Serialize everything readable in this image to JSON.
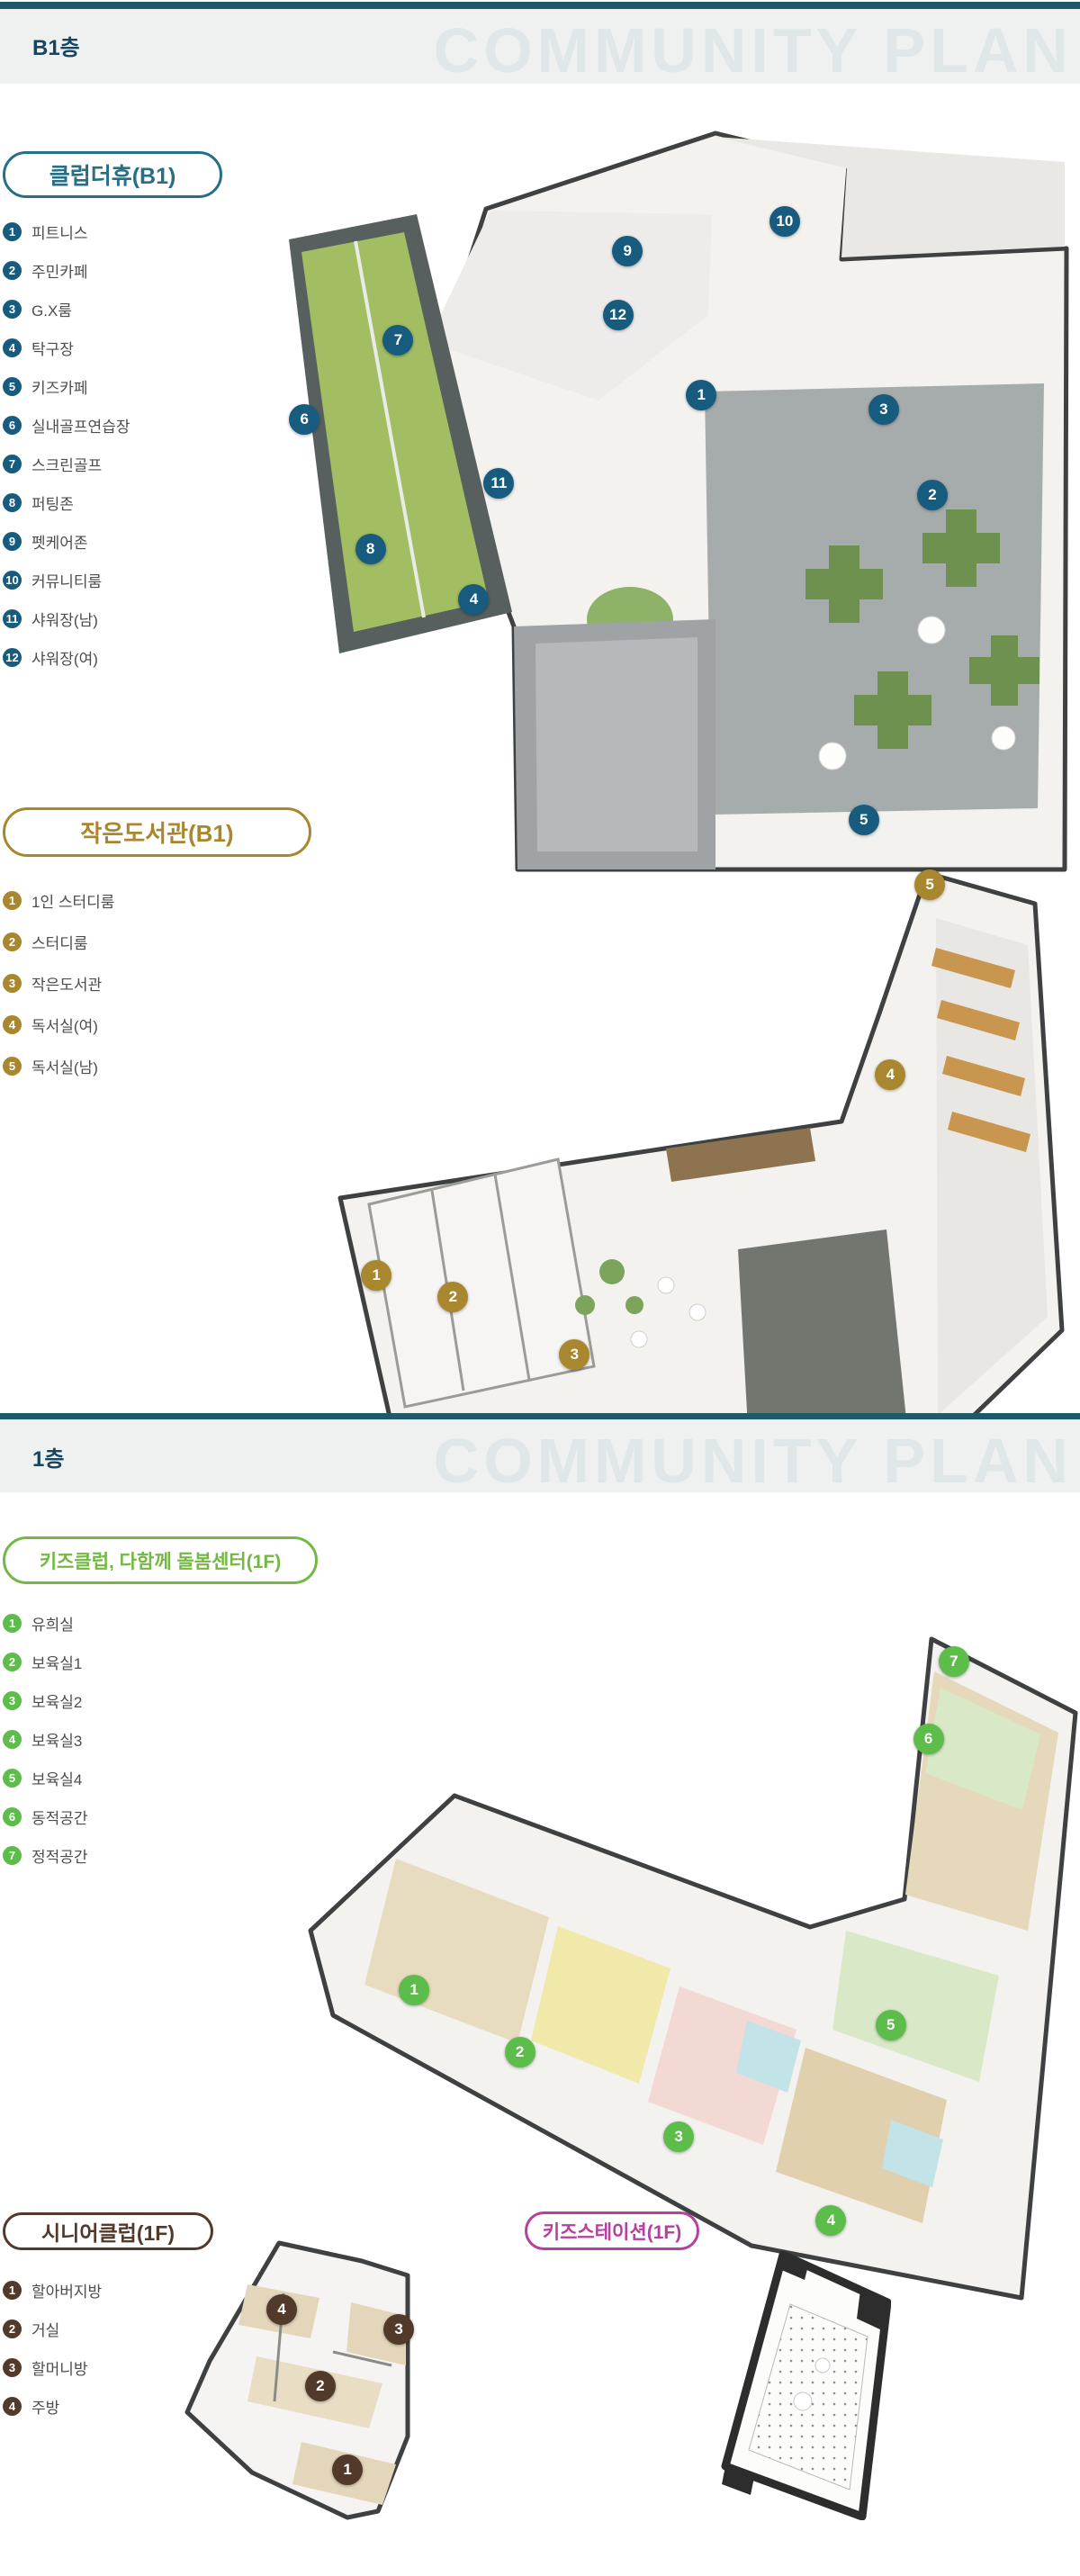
{
  "sections": [
    {
      "floor_label": "B1층",
      "watermark": "COMMUNITY PLAN"
    },
    {
      "floor_label": "1층",
      "watermark": "COMMUNITY PLAN"
    }
  ],
  "accent_line_color": "#1e5b68",
  "groups": [
    {
      "id": "club",
      "title": "클럽더휴(B1)",
      "accent_color": "#266f85",
      "badge_color": "#175b7e",
      "items": [
        "피트니스",
        "주민카페",
        "G.X룸",
        "탁구장",
        "키즈카페",
        "실내골프연습장",
        "스크린골프",
        "퍼팅존",
        "펫케어존",
        "커뮤니티룸",
        "샤워장(남)",
        "샤워장(여)"
      ],
      "markers": [
        {
          "n": "1",
          "x": 56.4,
          "y": 35.8
        },
        {
          "n": "2",
          "x": 83.0,
          "y": 49.1
        },
        {
          "n": "3",
          "x": 77.4,
          "y": 37.7
        },
        {
          "n": "4",
          "x": 30.2,
          "y": 63.0
        },
        {
          "n": "5",
          "x": 75.1,
          "y": 92.3
        },
        {
          "n": "6",
          "x": 10.7,
          "y": 39.0
        },
        {
          "n": "7",
          "x": 21.5,
          "y": 28.5
        },
        {
          "n": "8",
          "x": 18.3,
          "y": 56.3
        },
        {
          "n": "9",
          "x": 47.9,
          "y": 16.6
        },
        {
          "n": "10",
          "x": 66.0,
          "y": 12.7
        },
        {
          "n": "11",
          "x": 33.1,
          "y": 47.5
        },
        {
          "n": "12",
          "x": 46.8,
          "y": 25.1
        }
      ]
    },
    {
      "id": "library",
      "title": "작은도서관(B1)",
      "accent_color": "#a8872e",
      "badge_color": "#a8872e",
      "items": [
        "1인 스터디룸",
        "스터디룸",
        "작은도서관",
        "독서실(여)",
        "독서실(남)"
      ],
      "markers": [
        {
          "n": "1",
          "x": 9.1,
          "y": 68.4
        },
        {
          "n": "2",
          "x": 19.0,
          "y": 71.9
        },
        {
          "n": "3",
          "x": 34.7,
          "y": 81.2
        },
        {
          "n": "4",
          "x": 75.5,
          "y": 36.1
        },
        {
          "n": "5",
          "x": 80.6,
          "y": 5.5
        }
      ]
    },
    {
      "id": "kids",
      "title": "키즈클럽, 다함께 돌봄센터(1F)",
      "accent_color": "#74b843",
      "badge_color": "#5cbd4a",
      "items": [
        "유희실",
        "보육실1",
        "보육실2",
        "보육실3",
        "보육실4",
        "동적공간",
        "정적공간"
      ],
      "markers": [
        {
          "n": "1",
          "x": 18.7,
          "y": 53.2
        },
        {
          "n": "2",
          "x": 31.6,
          "y": 62.4
        },
        {
          "n": "3",
          "x": 51.0,
          "y": 75.0
        },
        {
          "n": "4",
          "x": 69.6,
          "y": 87.5
        },
        {
          "n": "5",
          "x": 76.9,
          "y": 58.4
        },
        {
          "n": "6",
          "x": 81.5,
          "y": 15.7
        },
        {
          "n": "7",
          "x": 84.6,
          "y": 4.2
        }
      ]
    },
    {
      "id": "senior",
      "title": "시니어클럽(1F)",
      "accent_color": "#523a2b",
      "badge_color": "#523a2b",
      "items": [
        "할아버지방",
        "거실",
        "할머니방",
        "주방"
      ],
      "markers": [
        {
          "n": "1",
          "x": 69.5,
          "y": 80.5
        },
        {
          "n": "2",
          "x": 58.5,
          "y": 51.3
        },
        {
          "n": "3",
          "x": 90.2,
          "y": 31.4
        },
        {
          "n": "4",
          "x": 42.9,
          "y": 24.5
        }
      ]
    },
    {
      "id": "kidsstation",
      "title": "키즈스테이션(1F)",
      "accent_color": "#b4409f",
      "badge_color": "#b4409f",
      "items": [],
      "markers": []
    }
  ]
}
